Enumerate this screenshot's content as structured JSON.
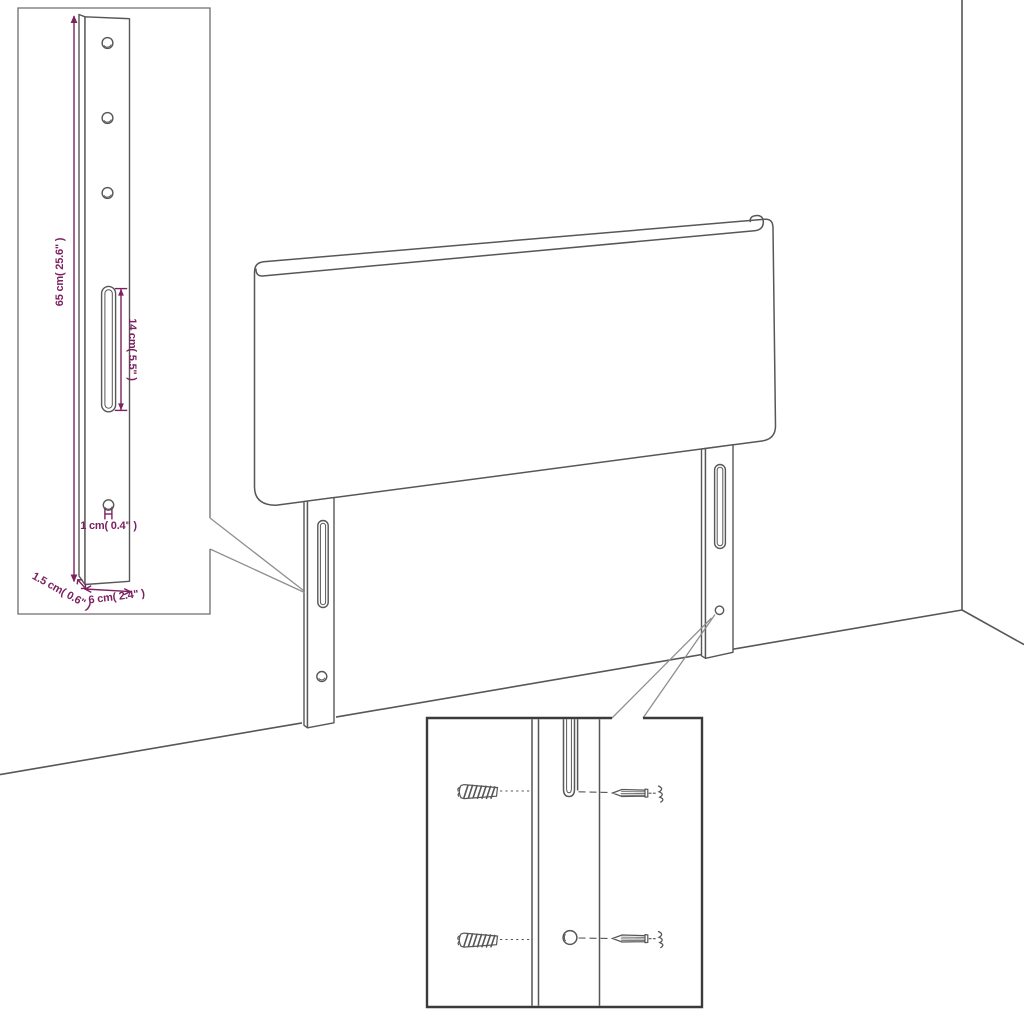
{
  "colors": {
    "background": "#ffffff",
    "line": "#575757",
    "inset_border": "#6e6e6e",
    "detail_border": "#3b3b3b",
    "callout": "#8f8f8f",
    "dimension": "#7c2161"
  },
  "bracket_detail_inset": {
    "dim_total_height": "65 cm( 25.6\" )",
    "dim_slot_length": "14 cm( 5.5\" )",
    "dim_hole_diameter": "1 cm( 0.4\" )",
    "dim_side_depth": "1.5 cm( 0.6\" )",
    "dim_width": "6 cm( 2.4\" )"
  },
  "mounting_detail_inset": {
    "icons": {
      "wall_plug_top": "wall-anchor-icon",
      "wall_plug_bottom": "wall-anchor-icon",
      "screw_top": "screw-icon",
      "screw_bottom": "screw-icon"
    }
  }
}
